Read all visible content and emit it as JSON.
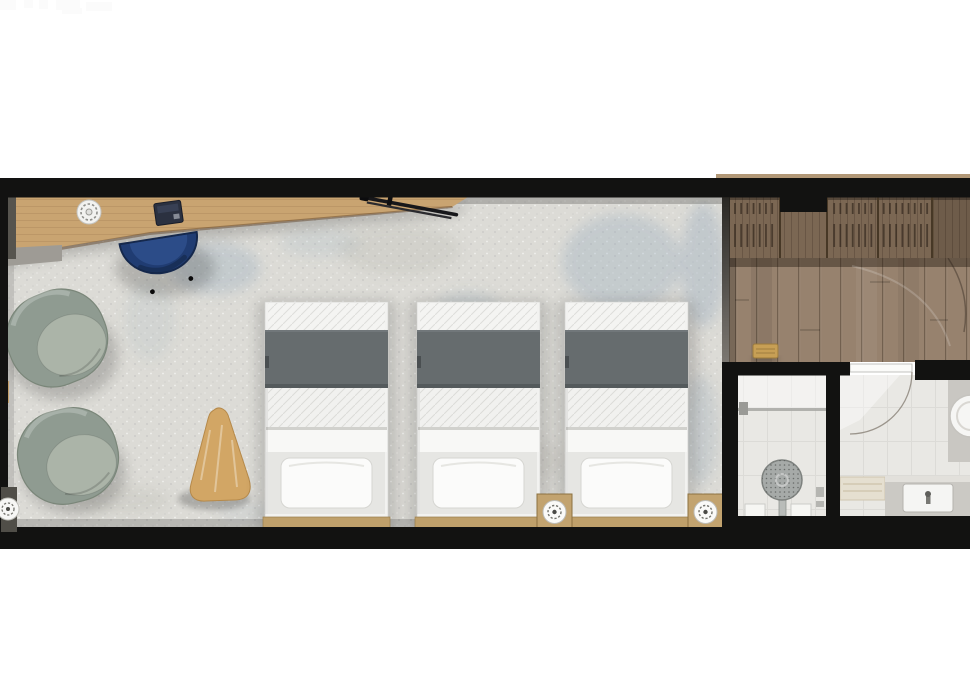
{
  "document": {
    "type": "floor-plan",
    "description": "Top-down architectural rendering of a long hotel guest room: lounge/desk zone and three single beds on a light mottled carpet, a wood-floor entry hall with wardrobes, and a two-part bathroom (shower room and vanity room) at the right. Plan is cropped by the right edge of the image.",
    "visible_text": ""
  },
  "rooms": [
    {
      "name": "bedroom-lounge",
      "floor": "light mottled carpet with blue-gray patches",
      "furniture": [
        "wall-desk",
        "desk-side-panel",
        "desk-plate",
        "laptop",
        "ski-set",
        "desk-chair-navy",
        "armchair-1",
        "armchair-2",
        "side-table-triangle",
        "bed-1",
        "bed-2",
        "bed-3",
        "nightstand-1",
        "nightstand-2",
        "floor-lamp-left"
      ]
    },
    {
      "name": "entry-hall",
      "floor": "dark wood planks",
      "furniture": [
        "wardrobe-hanging-1",
        "wardrobe-hanging-2",
        "wardrobe-hanging-3",
        "wardrobe-cabinet",
        "bench-gold",
        "entry-door-swing"
      ]
    },
    {
      "name": "shower-room",
      "floor": "white tile",
      "furniture": [
        "glass-screen",
        "shower-control",
        "rain-shower-head",
        "niche-shelf-1",
        "niche-shelf-2",
        "wall-accessory"
      ]
    },
    {
      "name": "bathroom-vanity-room",
      "floor": "white tile",
      "furniture": [
        "bathroom-door",
        "door-swing-arc",
        "towel-shelf",
        "vanity-counter",
        "rect-sink",
        "faucet",
        "side-counter",
        "round-basin"
      ]
    }
  ],
  "counts": {
    "beds": 3,
    "armchairs": 2,
    "nightstand_lamps": 2
  },
  "colors": {
    "wall": "#121211",
    "carpet": "#dcdbd6",
    "carpet_blue_tint": "#8fa5b8",
    "wood_floor": "#97826e",
    "wardrobe_wood": "#7b6753",
    "desk_wood": "#c9a471",
    "desk_side": "#56544e",
    "chair_navy": "#203c72",
    "armchair_body": "#8f9b91",
    "armchair_cushion": "#abb4a8",
    "side_table_wood": "#d2a665",
    "bed_linen": "#f2f2f0",
    "blanket_gray": "#666c6e",
    "pillow_white": "#fbfbfa",
    "headboard_wood": "#bfa06b",
    "nightstand_wood": "#c2a36f",
    "bench_gold": "#c79f55",
    "tile": "#e9e8e4",
    "vanity_counter": "#cbc9c4",
    "sink_white": "#f5f5f3",
    "shower_head_gray": "#a6aaa8",
    "glass_gray": "#a7a7a3",
    "shelf_beige": "#e5dfd0",
    "door_white": "#fbfbf9"
  }
}
